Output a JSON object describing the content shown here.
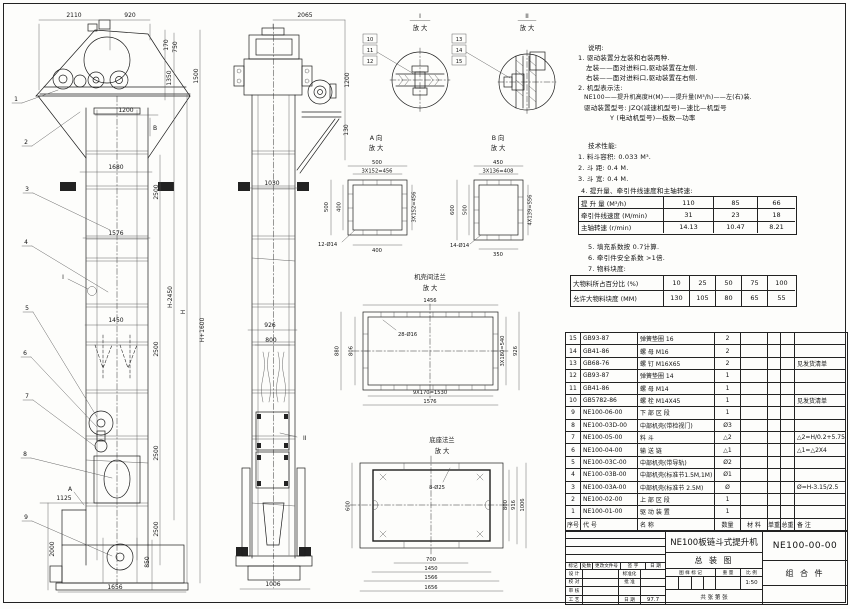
{
  "notes": {
    "heading": "说明:",
    "lines": [
      "1. 驱动装置分左装和右装两种.",
      "左装——面对进料口,驱动装置在左侧.",
      "右装——面对进料口,驱动装置在右侧.",
      "2. 机型表示法:",
      "NE100——提升机高度H(M)——提升量(M³/h)——左(右)装.",
      "驱动装置型号: JZQ(减速机型号)—速比—机型号",
      "Y (电动机型号)—极数—功率"
    ]
  },
  "performance": {
    "heading": "技术性能:",
    "items_before": [
      "1. 料斗容积: 0.033 M³.",
      "2. 斗  距: 0.4 M.",
      "3. 斗  宽: 0.4 M.",
      "4. 提升量、牵引件线速度和主轴转速:"
    ],
    "capacity_table": {
      "rows": [
        {
          "label": "提 升 量  (M³/h)",
          "v0": "110",
          "v1": "85",
          "v2": "66"
        },
        {
          "label": "牵引件线速度 (M/min)",
          "v0": "31",
          "v1": "23",
          "v2": "18"
        },
        {
          "label": "主轴转速 (r/min)",
          "v0": "14.13",
          "v1": "10.47",
          "v2": "8.21"
        }
      ]
    },
    "items_after": [
      "5. 填充系数按 0.7计算.",
      "6. 牵引件安全系数 >1倍.",
      "7. 物料块度:"
    ],
    "lump_table": {
      "rows": [
        {
          "label": "大物料所占百分比 (%)",
          "v0": "10",
          "v1": "25",
          "v2": "50",
          "v3": "75",
          "v4": "100"
        },
        {
          "label": "允许大物料块度 (MM)",
          "v0": "130",
          "v1": "105",
          "v2": "80",
          "v3": "65",
          "v4": "55"
        }
      ]
    }
  },
  "bom": {
    "header": {
      "no": "序号",
      "code": "代  号",
      "name": "名  称",
      "qty": "数量",
      "material": "材  料",
      "uw": "单重",
      "tw": "总重",
      "remark": "备  注"
    },
    "rows": [
      {
        "no": "15",
        "code": "GB93-87",
        "name": "弹簧垫圈  16",
        "qty": "2",
        "remark": ""
      },
      {
        "no": "14",
        "code": "GB41-86",
        "name": "螺 母  M16",
        "qty": "2",
        "remark": ""
      },
      {
        "no": "13",
        "code": "GB68-76",
        "name": "螺 钉  M16X65",
        "qty": "2",
        "remark": "见发货清单"
      },
      {
        "no": "12",
        "code": "GB93-87",
        "name": "弹簧垫圈  14",
        "qty": "1",
        "remark": ""
      },
      {
        "no": "11",
        "code": "GB41-86",
        "name": "螺 母  M14",
        "qty": "1",
        "remark": ""
      },
      {
        "no": "10",
        "code": "GB5782-86",
        "name": "螺 栓  M14X45",
        "qty": "1",
        "remark": "见发货清单"
      },
      {
        "no": "9",
        "code": "NE100-06-00",
        "name": "下 部 区 段",
        "qty": "1",
        "remark": ""
      },
      {
        "no": "8",
        "code": "NE100-03D-00",
        "name": "中部机壳(带检视门)",
        "qty": "Ø3",
        "remark": ""
      },
      {
        "no": "7",
        "code": "NE100-05-00",
        "name": "料 斗",
        "qty": "△2",
        "remark": "△2=H/0.2+5.75"
      },
      {
        "no": "6",
        "code": "NE100-04-00",
        "name": "输 送 链",
        "qty": "△1",
        "remark": "△1=△2X4"
      },
      {
        "no": "5",
        "code": "NE100-03C-00",
        "name": "中部机壳(带导轨)",
        "qty": "Ø2",
        "remark": ""
      },
      {
        "no": "4",
        "code": "NE100-03B-00",
        "name": "中部机壳(标准节1.5M,1M)",
        "qty": "Ø1",
        "remark": ""
      },
      {
        "no": "3",
        "code": "NE100-03A-00",
        "name": "中部机壳(标准节 2.5M)",
        "qty": "Ø",
        "remark": "Ø=H-3.15/2.5"
      },
      {
        "no": "2",
        "code": "NE100-02-00",
        "name": "上 部 区 段",
        "qty": "1",
        "remark": ""
      },
      {
        "no": "1",
        "code": "NE100-01-00",
        "name": "驱 动 装 置",
        "qty": "1",
        "remark": ""
      }
    ]
  },
  "title_block": {
    "title_line1": "NE100板链斗式提升机",
    "title_line2": "总  装  图",
    "drawing_no": "NE100-00-00",
    "part_type": "组 合 件",
    "rev_headers": [
      "标记",
      "处数",
      "更改文件号",
      "签 字",
      "日 期"
    ],
    "r1l": "设 计",
    "r1m": "标准化",
    "r2l": "校 对",
    "r2m": "批 准",
    "r3l": "审 核",
    "r3m": "",
    "r4l": "工 艺",
    "r4m": "日 期",
    "date": "97.7",
    "mark_label": "图 样 标 记",
    "weight_label": "重 量",
    "scale_label": "比 例",
    "scale": "1:50",
    "sheet_row": "共    张    第    张"
  },
  "dims": {
    "front": {
      "w2110": "2110",
      "w920": "920",
      "h170": "170",
      "h750": "750",
      "h1350": "1350",
      "h1500": "1500",
      "w1200": "1200",
      "w1680": "1680",
      "c2500a": "2500",
      "w1576": "1576",
      "hp": "H+1600",
      "hm": "H-2450",
      "h": "H",
      "w1450": "1450",
      "c2500b": "2500",
      "c2500c": "2500",
      "c2500d": "2500",
      "w1125": "1125",
      "h2000": "2000",
      "h850": "850",
      "w1656": "1656",
      "mk_a": "A",
      "mk_b": "B",
      "mk_i": "I"
    },
    "side": {
      "w2065": "2065",
      "h1200": "1200",
      "h130": "130",
      "w1030": "1030",
      "w926": "926",
      "w800": "800",
      "mk_ii": "II",
      "w1006": "1006"
    },
    "balloons": {
      "b1": "1",
      "b2": "2",
      "b3": "3",
      "b4": "4",
      "b5": "5",
      "b6": "6",
      "b7": "7",
      "b8": "8",
      "b9": "9"
    },
    "detail1": {
      "t": "I",
      "sub": "放 大",
      "b10": "10",
      "b11": "11",
      "b12": "12"
    },
    "detail2": {
      "t": "II",
      "sub": "放 大",
      "b13": "13",
      "b14": "14",
      "b15": "15"
    },
    "viewA": {
      "t": "A 向",
      "sub": "放 大",
      "d500t": "500",
      "d456t": "3X152=456",
      "d500l": "500",
      "d400l": "400",
      "d456r": "3X152=456",
      "holes": "12-Ø14",
      "d400b": "400"
    },
    "viewB": {
      "t": "B 向",
      "sub": "放 大",
      "d450": "450",
      "d408": "3X136=408",
      "d600": "600",
      "d500": "500",
      "d556": "4X139=556",
      "holes": "14-Ø14",
      "d350": "350"
    },
    "flange": {
      "t": "机壳间法兰",
      "sub": "放 大",
      "d1456": "1456",
      "holes": "28-Ø16",
      "d880": "880",
      "d806": "806",
      "d540": "3X180=540",
      "d926": "926",
      "d1530": "9X170=1530",
      "d1576": "1576"
    },
    "base": {
      "t": "底座法兰",
      "sub": "放 大",
      "holes": "8-Ø25",
      "d600": "600",
      "d800": "800",
      "d916": "916",
      "d1006": "1006",
      "d700": "700",
      "d1450": "1450",
      "d1566": "1566",
      "d1656": "1656"
    }
  }
}
